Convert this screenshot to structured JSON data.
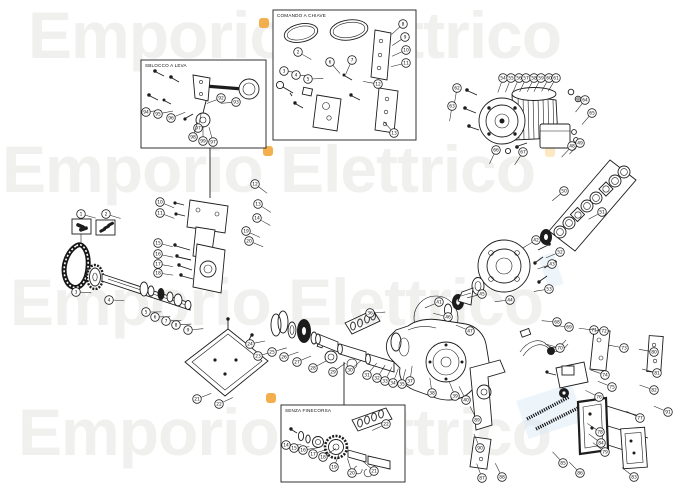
{
  "watermark": {
    "text": "Emporio Elettrico",
    "color": "#f0f0ee",
    "accent_orange": "#f2a63b",
    "accent_orange_soft": "#fbe3b4",
    "accent_blue_soft": "#d7e9f6",
    "rows": [
      {
        "x": 28,
        "y": 2
      },
      {
        "x": 2,
        "y": 136
      },
      {
        "x": 10,
        "y": 269
      },
      {
        "x": 18,
        "y": 399
      }
    ],
    "orange_dots": [
      {
        "x": 259,
        "y": 18,
        "s": 10,
        "soft": false
      },
      {
        "x": 263,
        "y": 146,
        "s": 10,
        "soft": false
      },
      {
        "x": 545,
        "y": 147,
        "s": 10,
        "soft": true
      },
      {
        "x": 266,
        "y": 393,
        "s": 10,
        "soft": false
      }
    ],
    "blue_marks": [
      {
        "x": 543,
        "y": 254,
        "w": 16,
        "h": 33
      },
      {
        "x": 521,
        "y": 391,
        "w": 58,
        "h": 40
      }
    ]
  },
  "insets": [
    {
      "id": "release-lever",
      "label": "SBLOCCO A LEVA"
    },
    {
      "id": "key-release",
      "label": "COMANDO A CHIAVE"
    },
    {
      "id": "no-limit-switch",
      "label": "SENZA FINECORSA"
    }
  ],
  "balloon_style": {
    "radius": 4.3,
    "stroke": "#222222"
  },
  "balloons": [
    {
      "n": "1",
      "x": 81,
      "y": 214
    },
    {
      "n": "2",
      "x": 106,
      "y": 214
    },
    {
      "n": "3",
      "x": 76,
      "y": 292
    },
    {
      "n": "4",
      "x": 109,
      "y": 300
    },
    {
      "n": "5",
      "x": 146,
      "y": 312
    },
    {
      "n": "6",
      "x": 155,
      "y": 317
    },
    {
      "n": "7",
      "x": 166,
      "y": 321
    },
    {
      "n": "8",
      "x": 176,
      "y": 325
    },
    {
      "n": "9",
      "x": 188,
      "y": 330
    },
    {
      "n": "10",
      "x": 160,
      "y": 202
    },
    {
      "n": "11",
      "x": 160,
      "y": 213
    },
    {
      "n": "12",
      "x": 255,
      "y": 184
    },
    {
      "n": "13",
      "x": 258,
      "y": 204
    },
    {
      "n": "14",
      "x": 257,
      "y": 218
    },
    {
      "n": "15",
      "x": 158,
      "y": 243
    },
    {
      "n": "16",
      "x": 158,
      "y": 254
    },
    {
      "n": "17",
      "x": 158,
      "y": 264
    },
    {
      "n": "18",
      "x": 158,
      "y": 273
    },
    {
      "n": "19",
      "x": 246,
      "y": 231
    },
    {
      "n": "20",
      "x": 249,
      "y": 241
    },
    {
      "n": "21",
      "x": 197,
      "y": 399
    },
    {
      "n": "22",
      "x": 219,
      "y": 404
    },
    {
      "n": "23",
      "x": 258,
      "y": 356
    },
    {
      "n": "24",
      "x": 250,
      "y": 344
    },
    {
      "n": "25",
      "x": 272,
      "y": 352
    },
    {
      "n": "26",
      "x": 284,
      "y": 357
    },
    {
      "n": "27",
      "x": 297,
      "y": 362
    },
    {
      "n": "28",
      "x": 313,
      "y": 368
    },
    {
      "n": "29",
      "x": 333,
      "y": 372
    },
    {
      "n": "30",
      "x": 350,
      "y": 370
    },
    {
      "n": "31",
      "x": 367,
      "y": 375
    },
    {
      "n": "32",
      "x": 377,
      "y": 378
    },
    {
      "n": "33",
      "x": 385,
      "y": 381
    },
    {
      "n": "34",
      "x": 393,
      "y": 383
    },
    {
      "n": "35",
      "x": 402,
      "y": 384
    },
    {
      "n": "36",
      "x": 370,
      "y": 313
    },
    {
      "n": "37",
      "x": 410,
      "y": 381
    },
    {
      "n": "38",
      "x": 432,
      "y": 393
    },
    {
      "n": "39",
      "x": 455,
      "y": 396
    },
    {
      "n": "40",
      "x": 466,
      "y": 400
    },
    {
      "n": "41",
      "x": 439,
      "y": 302
    },
    {
      "n": "42",
      "x": 536,
      "y": 240
    },
    {
      "n": "43",
      "x": 552,
      "y": 264
    },
    {
      "n": "44",
      "x": 510,
      "y": 300
    },
    {
      "n": "45",
      "x": 482,
      "y": 294
    },
    {
      "n": "46",
      "x": 448,
      "y": 317
    },
    {
      "n": "47",
      "x": 470,
      "y": 331
    },
    {
      "n": "48",
      "x": 572,
      "y": 146
    },
    {
      "n": "49",
      "x": 580,
      "y": 143
    },
    {
      "n": "50",
      "x": 564,
      "y": 191
    },
    {
      "n": "51",
      "x": 602,
      "y": 212
    },
    {
      "n": "52",
      "x": 560,
      "y": 252
    },
    {
      "n": "53",
      "x": 549,
      "y": 289
    },
    {
      "n": "54",
      "x": 503,
      "y": 78
    },
    {
      "n": "55",
      "x": 511,
      "y": 78
    },
    {
      "n": "56",
      "x": 519,
      "y": 78
    },
    {
      "n": "57",
      "x": 526,
      "y": 78
    },
    {
      "n": "58",
      "x": 534,
      "y": 78
    },
    {
      "n": "59",
      "x": 541,
      "y": 78
    },
    {
      "n": "60",
      "x": 549,
      "y": 78
    },
    {
      "n": "61",
      "x": 556,
      "y": 78
    },
    {
      "n": "62",
      "x": 457,
      "y": 88
    },
    {
      "n": "63",
      "x": 452,
      "y": 106
    },
    {
      "n": "64",
      "x": 585,
      "y": 100
    },
    {
      "n": "65",
      "x": 592,
      "y": 113
    },
    {
      "n": "66",
      "x": 496,
      "y": 150
    },
    {
      "n": "67",
      "x": 523,
      "y": 152
    },
    {
      "n": "68",
      "x": 557,
      "y": 322
    },
    {
      "n": "69",
      "x": 569,
      "y": 327
    },
    {
      "n": "70",
      "x": 560,
      "y": 348
    },
    {
      "n": "71",
      "x": 594,
      "y": 330
    },
    {
      "n": "72",
      "x": 604,
      "y": 331
    },
    {
      "n": "73",
      "x": 624,
      "y": 348
    },
    {
      "n": "74",
      "x": 605,
      "y": 375
    },
    {
      "n": "75",
      "x": 612,
      "y": 387
    },
    {
      "n": "76",
      "x": 599,
      "y": 397
    },
    {
      "n": "77",
      "x": 640,
      "y": 418
    },
    {
      "n": "78",
      "x": 600,
      "y": 432
    },
    {
      "n": "79",
      "x": 605,
      "y": 452
    },
    {
      "n": "80",
      "x": 654,
      "y": 352
    },
    {
      "n": "81",
      "x": 657,
      "y": 373
    },
    {
      "n": "82",
      "x": 654,
      "y": 390
    },
    {
      "n": "83",
      "x": 634,
      "y": 477
    },
    {
      "n": "84",
      "x": 601,
      "y": 443
    },
    {
      "n": "85",
      "x": 563,
      "y": 463
    },
    {
      "n": "86",
      "x": 580,
      "y": 473
    },
    {
      "n": "87",
      "x": 482,
      "y": 478
    },
    {
      "n": "88",
      "x": 502,
      "y": 477
    },
    {
      "n": "89",
      "x": 477,
      "y": 420
    },
    {
      "n": "90",
      "x": 480,
      "y": 448
    },
    {
      "n": "91",
      "x": 668,
      "y": 412
    },
    {
      "n": "92",
      "x": 221,
      "y": 98
    },
    {
      "n": "93",
      "x": 236,
      "y": 102
    },
    {
      "n": "94",
      "x": 146,
      "y": 112
    },
    {
      "n": "95",
      "x": 158,
      "y": 114
    },
    {
      "n": "96",
      "x": 171,
      "y": 118
    },
    {
      "n": "97",
      "x": 198,
      "y": 128
    },
    {
      "n": "98",
      "x": 193,
      "y": 137
    },
    {
      "n": "99",
      "x": 203,
      "y": 141
    },
    {
      "n": "97",
      "x": 213,
      "y": 142
    },
    {
      "n": "2",
      "x": 298,
      "y": 52
    },
    {
      "n": "3",
      "x": 284,
      "y": 71
    },
    {
      "n": "4",
      "x": 296,
      "y": 75
    },
    {
      "n": "5",
      "x": 308,
      "y": 79
    },
    {
      "n": "6",
      "x": 330,
      "y": 62
    },
    {
      "n": "7",
      "x": 352,
      "y": 60
    },
    {
      "n": "8",
      "x": 403,
      "y": 24
    },
    {
      "n": "9",
      "x": 405,
      "y": 37
    },
    {
      "n": "10",
      "x": 406,
      "y": 50
    },
    {
      "n": "11",
      "x": 406,
      "y": 63
    },
    {
      "n": "12",
      "x": 378,
      "y": 84
    },
    {
      "n": "13",
      "x": 394,
      "y": 133
    },
    {
      "n": "14",
      "x": 286,
      "y": 445
    },
    {
      "n": "15",
      "x": 294,
      "y": 448
    },
    {
      "n": "16",
      "x": 303,
      "y": 450
    },
    {
      "n": "17",
      "x": 313,
      "y": 454
    },
    {
      "n": "18",
      "x": 323,
      "y": 457
    },
    {
      "n": "19",
      "x": 334,
      "y": 467
    },
    {
      "n": "20",
      "x": 352,
      "y": 473
    },
    {
      "n": "21",
      "x": 374,
      "y": 471
    },
    {
      "n": "22",
      "x": 386,
      "y": 424
    }
  ]
}
